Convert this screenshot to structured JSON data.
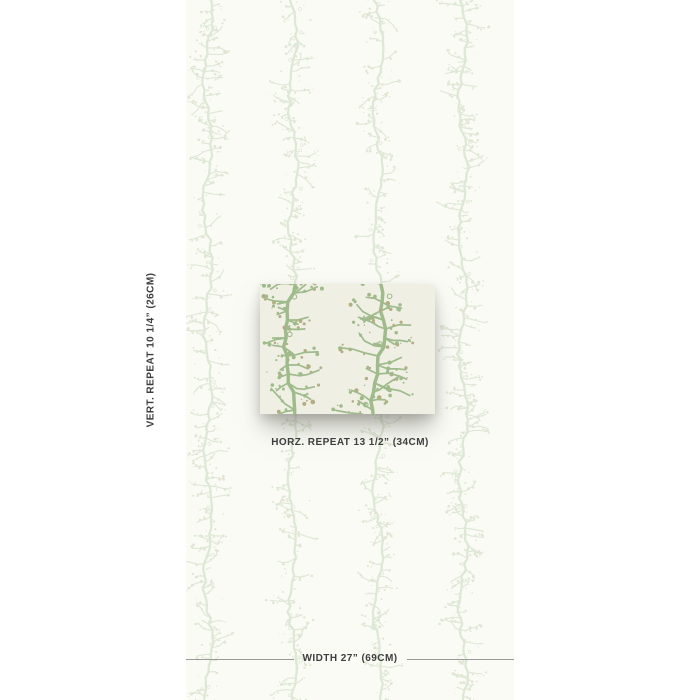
{
  "product": {
    "kind": "wallpaper-measurement-diagram",
    "pattern_name": "coral-branch-stripes"
  },
  "annotations": {
    "vertical_repeat": "VERT. REPEAT 10 1/4” (26CM)",
    "horizontal_repeat": "HORZ. REPEAT 13 1/2” (34CM)",
    "width": "WIDTH 27” (69CM)"
  },
  "colors": {
    "page_bg": "#ffffff",
    "panel_bg": "#fbfbf6",
    "swatch_bg": "#f0efe4",
    "text": "#3e3e3e",
    "line": "#9a9a9a",
    "pattern_light_green": "#ccdcc2",
    "pattern_light_dot": "#d7d4bb",
    "pattern_strong_green": "#9fbb8c",
    "pattern_strong_dot": "#b2ad82"
  },
  "pattern_layout": {
    "panel_left": 186,
    "panel_width": 328,
    "panel_height": 700,
    "bg_stripe_centers_x": [
      208,
      293,
      378,
      463
    ],
    "bg_opacity": 0.6,
    "swatch_left": 260,
    "swatch_top": 284,
    "swatch_width": 175,
    "swatch_height": 130,
    "swatch_stripe_centers_x": [
      292,
      378
    ],
    "swatch_scale": 1.5
  }
}
